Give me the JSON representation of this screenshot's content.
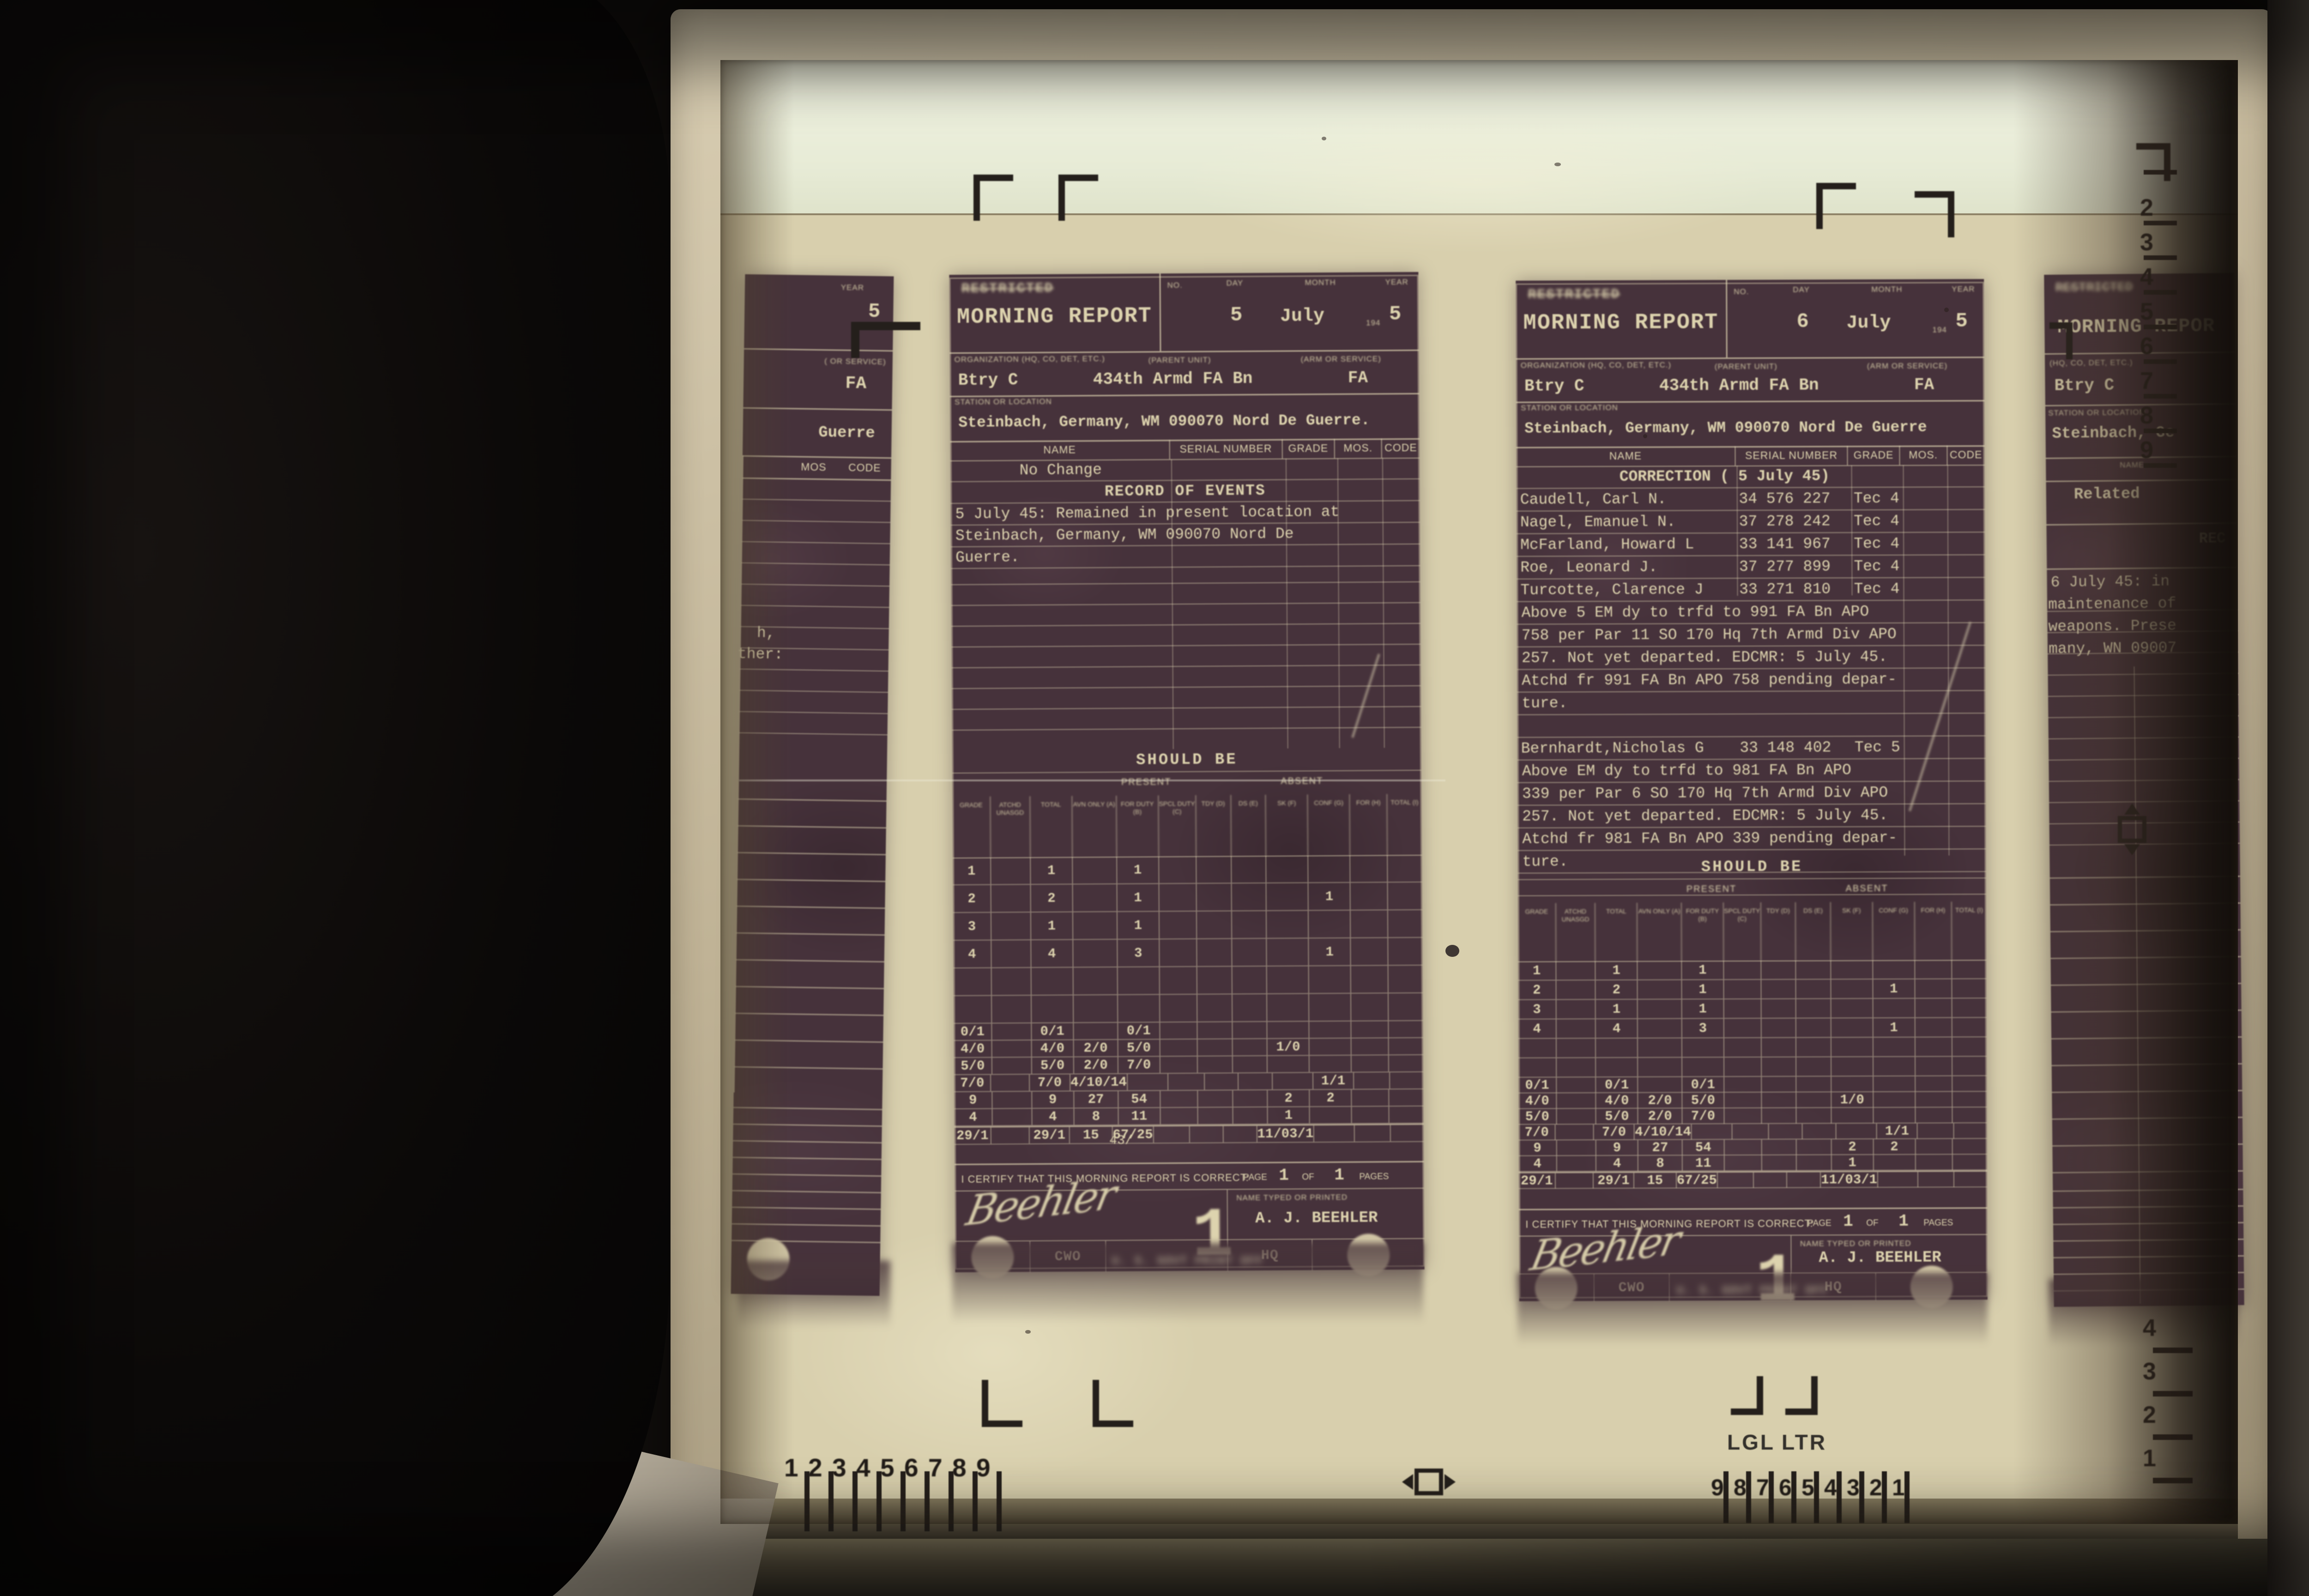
{
  "scene": {
    "machine_panel_label": "Roll/Fi",
    "paper_size_labels": {
      "legal": "LGL",
      "letter": "LTR"
    },
    "rulers": {
      "bottom_left": [
        "1",
        "2",
        "3",
        "4",
        "5",
        "6",
        "7",
        "8",
        "9"
      ],
      "bottom_right": [
        "9",
        "8",
        "7",
        "6",
        "5",
        "4",
        "3",
        "2",
        "1"
      ],
      "right_top": [
        "2",
        "3",
        "4",
        "5",
        "6",
        "7",
        "8",
        "9"
      ],
      "right_bottom": [
        "4",
        "3",
        "2",
        "1"
      ]
    }
  },
  "form": {
    "classification": "RESTRICTED",
    "title": "MORNING REPORT",
    "no_label": "NO.",
    "day_label": "DAY",
    "month_label": "MONTH",
    "year_label": "YEAR",
    "year_prefix": "194",
    "org_label": "ORGANIZATION (HQ, CO, DET, ETC.)",
    "parent_unit_label": "(PARENT UNIT)",
    "arm_label": "(ARM OR SERVICE)",
    "station_label": "STATION OR LOCATION",
    "columns": [
      "NAME",
      "SERIAL NUMBER",
      "GRADE",
      "MOS.",
      "CODE"
    ],
    "record_title": "RECORD OF EVENTS",
    "should_be": "SHOULD BE",
    "present_label": "PRESENT",
    "absent_label": "ABSENT",
    "stats_columns": [
      "GRADE",
      "ATCHD UNASGD",
      "TOTAL",
      "AVN ONLY (A)",
      "FOR DUTY (B)",
      "SPCL DUTY (C)",
      "TDY (D)",
      "DS (E)",
      "SK (F)",
      "CONF (G)",
      "FOR (H)",
      "TOTAL (I)"
    ],
    "certify": "I CERTIFY THAT THIS MORNING REPORT IS CORRECT:",
    "page_label": "PAGE",
    "of_label": "OF",
    "pages_label": "PAGES",
    "name_typed_label": "NAME TYPED OR PRINTED",
    "footer": "U. S. GOVT PRINT OFF"
  },
  "stats_rows": [
    [
      "1",
      "",
      "1",
      "",
      "1",
      "",
      "",
      "",
      "",
      "",
      "",
      ""
    ],
    [
      "2",
      "",
      "2",
      "",
      "1",
      "",
      "",
      "",
      "",
      "1",
      "",
      ""
    ],
    [
      "3",
      "",
      "1",
      "",
      "1",
      "",
      "",
      "",
      "",
      "",
      "",
      ""
    ],
    [
      "4",
      "",
      "4",
      "",
      "3",
      "",
      "",
      "",
      "",
      "1",
      "",
      ""
    ],
    [
      "",
      "",
      "",
      "",
      "",
      "",
      "",
      "",
      "",
      "",
      "",
      ""
    ],
    [
      "",
      "",
      "",
      "",
      "",
      "",
      "",
      "",
      "",
      "",
      "",
      ""
    ],
    [
      "0/1",
      "",
      "0/1",
      "",
      "0/1",
      "",
      "",
      "",
      "",
      "",
      "",
      ""
    ],
    [
      "4/0",
      "",
      "4/0",
      "2/0",
      "5/0",
      "",
      "",
      "",
      "1/0",
      "",
      "",
      ""
    ],
    [
      "5/0",
      "",
      "5/0",
      "2/0",
      "7/0",
      "",
      "",
      "",
      "",
      "",
      "",
      ""
    ],
    [
      "7/0",
      "",
      "7/0",
      "4/10/14",
      "",
      "",
      "",
      "",
      "",
      "1/1",
      "",
      ""
    ],
    [
      "9",
      "",
      "9",
      "27",
      "54",
      "",
      "",
      "",
      "2",
      "2",
      "",
      ""
    ],
    [
      "4",
      "",
      "4",
      "8",
      "11",
      "",
      "",
      "",
      "1",
      "",
      "",
      ""
    ],
    [
      "29/1",
      "",
      "29/1",
      "15",
      "67/25",
      "",
      "",
      "",
      "11/03/1",
      "",
      "",
      ""
    ]
  ],
  "doc_july5": {
    "day": "5",
    "month": "July",
    "year": "5",
    "org": "Btry C",
    "parent_unit": "434th Armd FA Bn",
    "arm": "FA",
    "station": "Steinbach, Germany, WM 090070 Nord De Guerre.",
    "entry": "No Change",
    "record_lines": [
      "5 July 45: Remained in present location at",
      "Steinbach, Germany, WM 090070 Nord De",
      "Guerre."
    ],
    "interline": "43/",
    "page": "1",
    "pages": "1",
    "signature_script": "Beehler",
    "signer": "A. J. BEEHLER",
    "grade": "CWO",
    "hq": "HQ",
    "stamp": "1"
  },
  "doc_july6": {
    "day": "6",
    "month": "July",
    "year": "5",
    "org": "Btry C",
    "parent_unit": "434th Armd FA Bn",
    "arm": "FA",
    "station": "Steinbach, Germany, WM 090070 Nord De Guerre",
    "correction_title": "CORRECTION ( 5 July 45)",
    "entries": [
      {
        "name": "Caudell, Carl N.",
        "serial": "34 576 227",
        "grade": "Tec 4"
      },
      {
        "name": "Nagel, Emanuel N.",
        "serial": "37 278 242",
        "grade": "Tec 4"
      },
      {
        "name": "McFarland, Howard L",
        "serial": "33 141 967",
        "grade": "Tec 4"
      },
      {
        "name": "Roe, Leonard J.",
        "serial": "37 277 899",
        "grade": "Tec 4"
      },
      {
        "name": "Turcotte, Clarence J",
        "serial": "33 271 810",
        "grade": "Tec 4"
      },
      {
        "name": "Bernhardt,Nicholas G",
        "serial": "33 148 402",
        "grade": "Tec 5"
      }
    ],
    "para1": [
      "Above 5 EM dy to trfd to 991 FA Bn APO",
      "758 per Par 11 SO 170 Hq 7th Armd Div APO",
      "257. Not yet departed. EDCMR: 5 July 45.",
      "Atchd fr 991 FA Bn APO 758 pending depar-",
      "ture."
    ],
    "para2": [
      "Above EM dy to trfd to 981 FA Bn APO",
      "339 per Par 6 SO 170 Hq 7th Armd Div APO",
      "257. Not yet departed. EDCMR: 5 July 45.",
      "Atchd fr 981 FA Bn APO 339 pending depar-",
      "ture."
    ],
    "page": "1",
    "pages": "1",
    "signature_script": "Beehler",
    "signer": "A. J. BEEHLER",
    "grade": "CWO",
    "hq": "HQ",
    "stamp": "1"
  },
  "doc_left_partial": {
    "year_label": "YEAR",
    "year": "5",
    "arm_label": "( OR SERVICE)",
    "arm": "FA",
    "station_fragment": "Guerre",
    "mos_label": "MOS",
    "code_label": "CODE",
    "line1": "h,",
    "line2": "ther:"
  },
  "doc_right_partial": {
    "classification": "RESTRICTED",
    "title": "MORNING REPOR",
    "org_label": "(HQ, CO, DET, ETC.)",
    "org": "Btry C",
    "station_label": "STATION OR LOCATION",
    "station": "Steinbach, Ge",
    "name_label": "NAME",
    "entry": "Related",
    "record": "REC",
    "lines": [
      "6 July 45: in",
      "maintenance of",
      "weapons. Prese",
      "many, WN 09007"
    ]
  },
  "colors": {
    "film": "#d8cfad",
    "document_ink": "#46323b",
    "document_text": "#ddd3ae",
    "screen_top_strip": "#edf0dd",
    "bezel": "#c7bb9f",
    "registration_mark": "#241f1b"
  }
}
